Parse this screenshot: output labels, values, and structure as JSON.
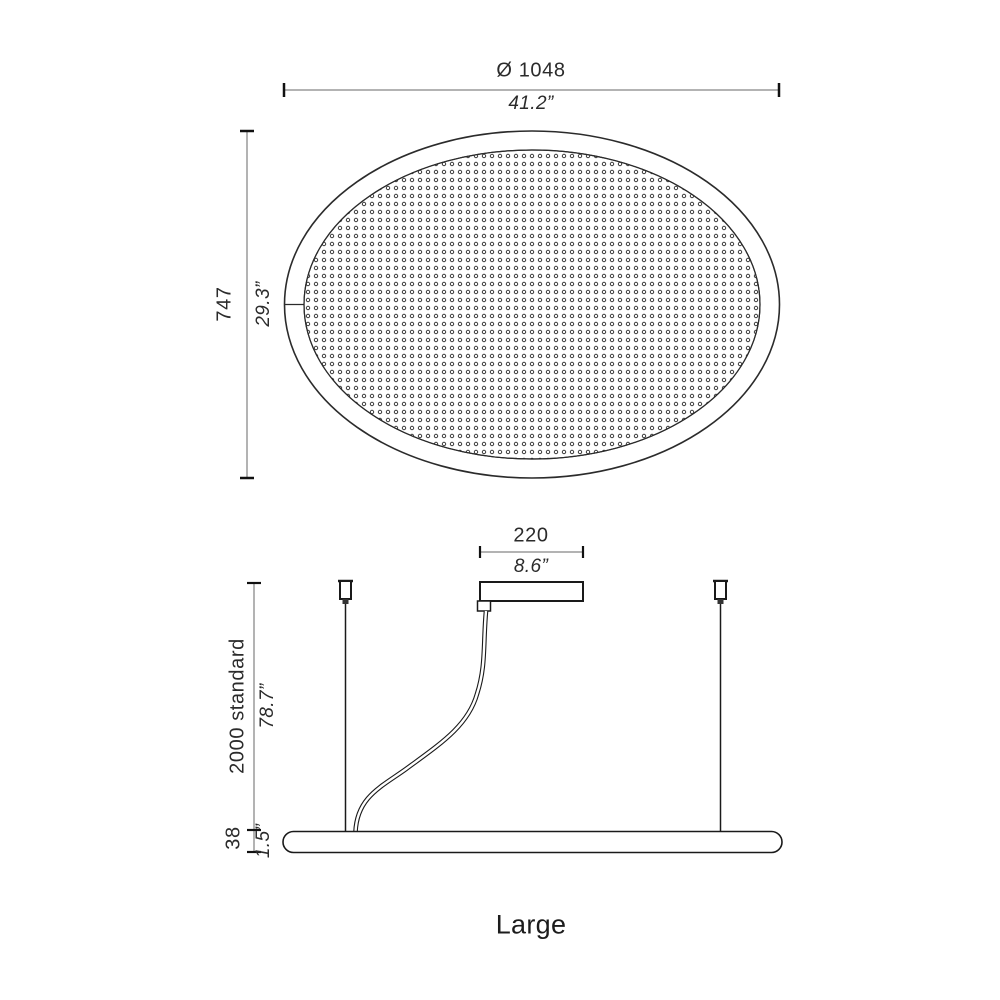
{
  "caption": "Large",
  "colors": {
    "drawing_line": "#1a1a1a",
    "dimension_line": "#b3b3b3",
    "tick": "#111111",
    "text": "#2b2b2b"
  },
  "top_view": {
    "diameter_mm": "Ø 1048",
    "diameter_in": "41.2”",
    "height_mm": "747",
    "height_in": "29.3”"
  },
  "side_view": {
    "canopy_width_mm": "220",
    "canopy_width_in": "8.6”",
    "suspension_length_mm": "2000 standard",
    "suspension_length_in": "78.7”",
    "profile_height_mm": "38",
    "profile_height_in": "1.5”"
  }
}
